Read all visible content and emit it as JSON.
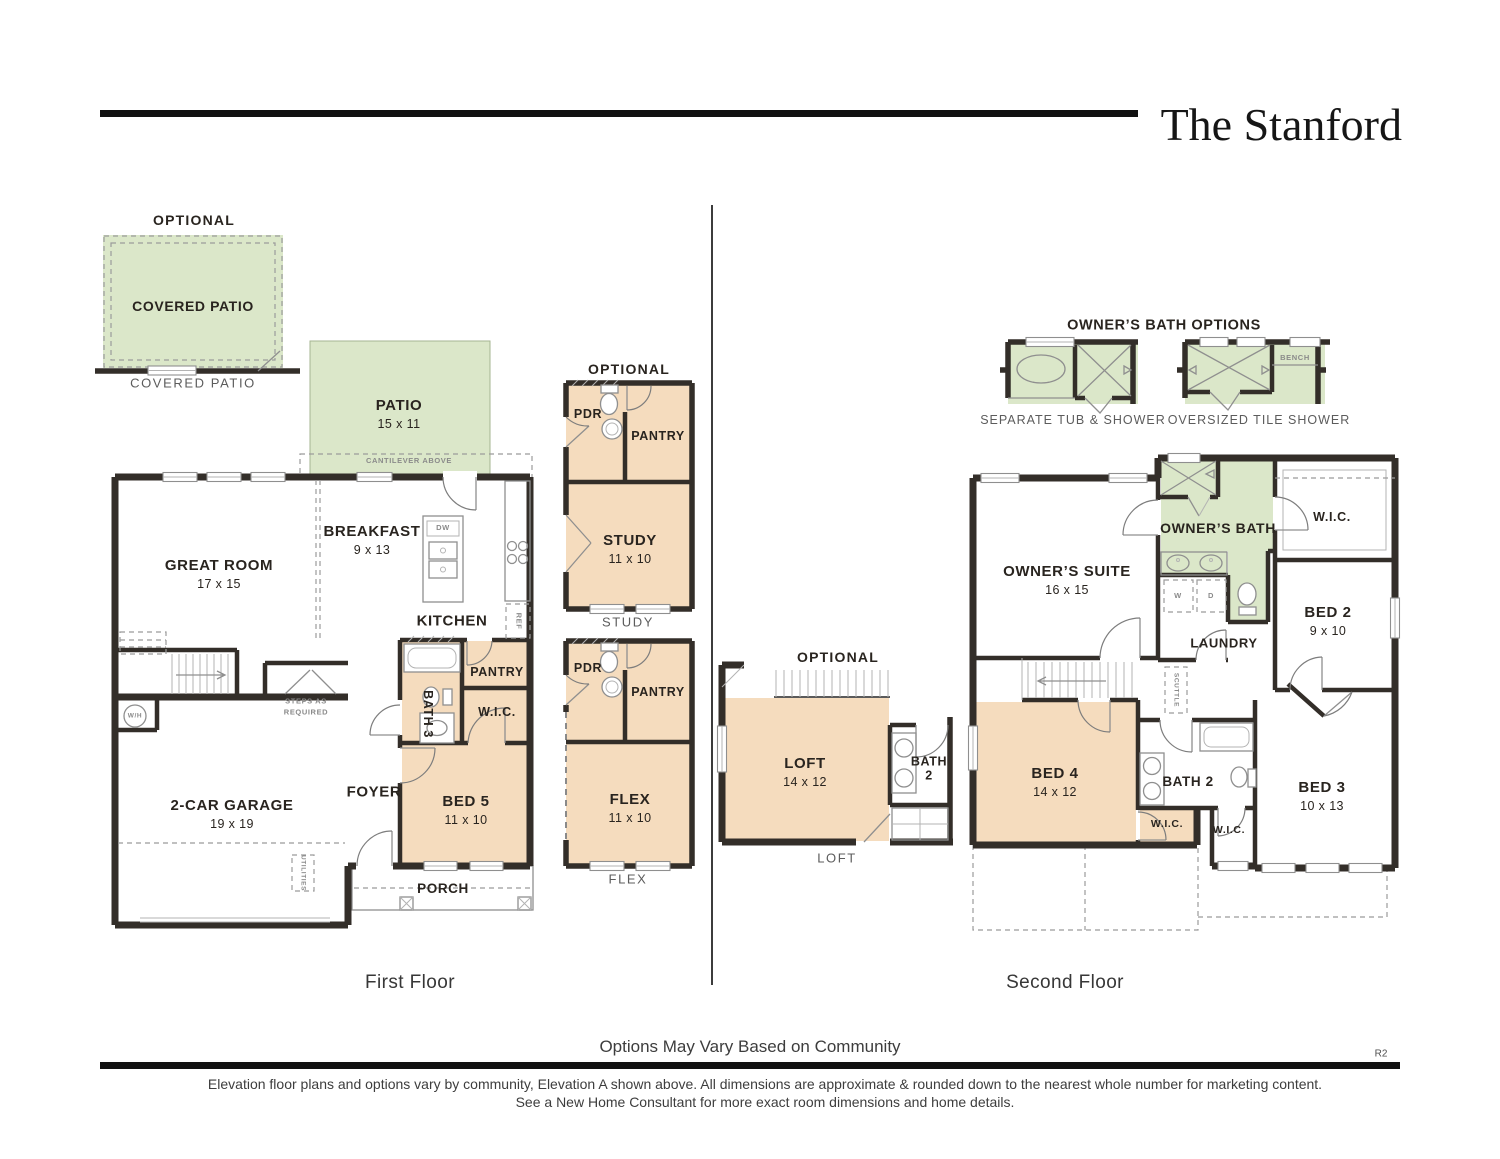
{
  "page": {
    "title": "The Stanford",
    "first_floor_label": "First Floor",
    "second_floor_label": "Second Floor",
    "options_note": "Options May Vary Based on Community",
    "revision": "R2",
    "disclaimer_line1": "Elevation floor plans and options vary by community, Elevation A shown above. All dimensions are approximate & rounded down to the nearest whole number for marketing content.",
    "disclaimer_line2": "See a New Home Consultant for more exact room dimensions and home details."
  },
  "colors": {
    "optional_green": "#dbe7c9",
    "room_tan": "#f5dcbe",
    "wall": "#332e29"
  },
  "first_floor": {
    "optional_label": "OPTIONAL",
    "covered_patio": {
      "name": "COVERED PATIO",
      "caption": "COVERED PATIO"
    },
    "patio": {
      "name": "PATIO",
      "dims": "15 x 11"
    },
    "cantilever_note": "CANTILEVER ABOVE",
    "great_room": {
      "name": "GREAT ROOM",
      "dims": "17 x 15"
    },
    "breakfast": {
      "name": "BREAKFAST",
      "dims": "9 x 13"
    },
    "kitchen": {
      "name": "KITCHEN"
    },
    "island_dw": "DW",
    "fridge": "REF",
    "bath3": {
      "name": "BATH 3"
    },
    "pantry": {
      "name": "PANTRY"
    },
    "wic": {
      "name": "W.I.C."
    },
    "bed5": {
      "name": "BED 5",
      "dims": "11 x 10"
    },
    "foyer": {
      "name": "FOYER"
    },
    "garage": {
      "name": "2-CAR GARAGE",
      "dims": "19 x 19"
    },
    "porch": {
      "name": "PORCH"
    },
    "water_heater": "W/H",
    "steps_note": "STEPS AS\nREQUIRED",
    "utilities": "UTILITIES"
  },
  "study_option": {
    "optional_label": "OPTIONAL",
    "pdr": "PDR",
    "pantry": "PANTRY",
    "study": {
      "name": "STUDY",
      "dims": "11 x 10"
    },
    "caption": "STUDY"
  },
  "flex_option": {
    "pdr": "PDR",
    "pantry": "PANTRY",
    "flex": {
      "name": "FLEX",
      "dims": "11 x 10"
    },
    "caption": "FLEX"
  },
  "second_floor": {
    "bath_options": {
      "title": "OWNER’S BATH OPTIONS",
      "option1_caption": "SEPARATE TUB & SHOWER",
      "option2_caption": "OVERSIZED TILE SHOWER",
      "bench_label": "BENCH"
    },
    "owners_suite": {
      "name": "OWNER’S SUITE",
      "dims": "16 x 15"
    },
    "owners_bath": {
      "name": "OWNER’S BATH"
    },
    "wic_owner": "W.I.C.",
    "bed2": {
      "name": "BED 2",
      "dims": "9 x 10"
    },
    "laundry": "LAUNDRY",
    "washer": "W",
    "dryer": "D",
    "scuttle": "SCUTTLE",
    "bed4": {
      "name": "BED 4",
      "dims": "14 x 12"
    },
    "bath2": "BATH 2",
    "wic_bed4": "W.I.C.",
    "wic_bed3": "W.I.C.",
    "bed3": {
      "name": "BED 3",
      "dims": "10 x 13"
    }
  },
  "loft_option": {
    "optional_label": "OPTIONAL",
    "loft": {
      "name": "LOFT",
      "dims": "14 x 12"
    },
    "bath2": "BATH\n2",
    "caption": "LOFT"
  }
}
